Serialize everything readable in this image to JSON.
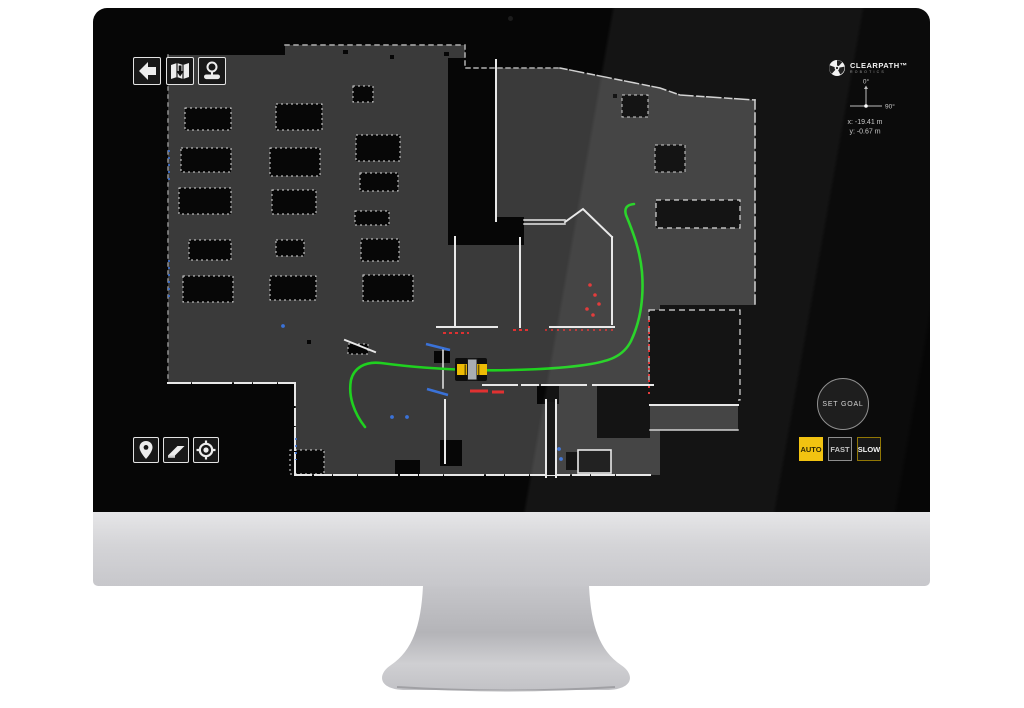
{
  "screen": {
    "brand": {
      "name": "CLEARPATH™",
      "sub": "ROBOTICS",
      "logo_icon": "clearpath-gear-logo"
    },
    "toolbar_top": {
      "buttons": [
        {
          "id": "back",
          "icon": "back-arrow-icon"
        },
        {
          "id": "map-save",
          "icon": "map-download-icon"
        },
        {
          "id": "map-scan",
          "icon": "map-scan-icon"
        }
      ]
    },
    "toolbar_bottom": {
      "buttons": [
        {
          "id": "waypoint",
          "icon": "location-pin-icon"
        },
        {
          "id": "erase",
          "icon": "eraser-icon"
        },
        {
          "id": "localize",
          "icon": "target-locate-icon"
        }
      ]
    },
    "compass": {
      "up_label": "0°",
      "right_label": "90°"
    },
    "position_readout": {
      "x": "x: -19.41 m",
      "y": "y: -0.67 m"
    },
    "goal": {
      "set_goal_label": "SET GOAL"
    },
    "speed_modes": [
      {
        "label": "AUTO",
        "active": true
      },
      {
        "label": "FAST",
        "active": false
      },
      {
        "label": "SLOW",
        "active": false
      }
    ],
    "map": {
      "description": "occupancy-grid floor map with planned path and robot",
      "robot_marker": "yellow-robot-top-view",
      "path_marker": "green-planned-path"
    },
    "colors": {
      "accent_yellow": "#f2c20c",
      "path_green": "#1fd11f",
      "scan_red": "#e03131",
      "scan_blue": "#3a72d8",
      "map_free_space": "#3a3a3a",
      "map_walls": "#e8e8e8",
      "screen_bg": "#060606"
    }
  }
}
